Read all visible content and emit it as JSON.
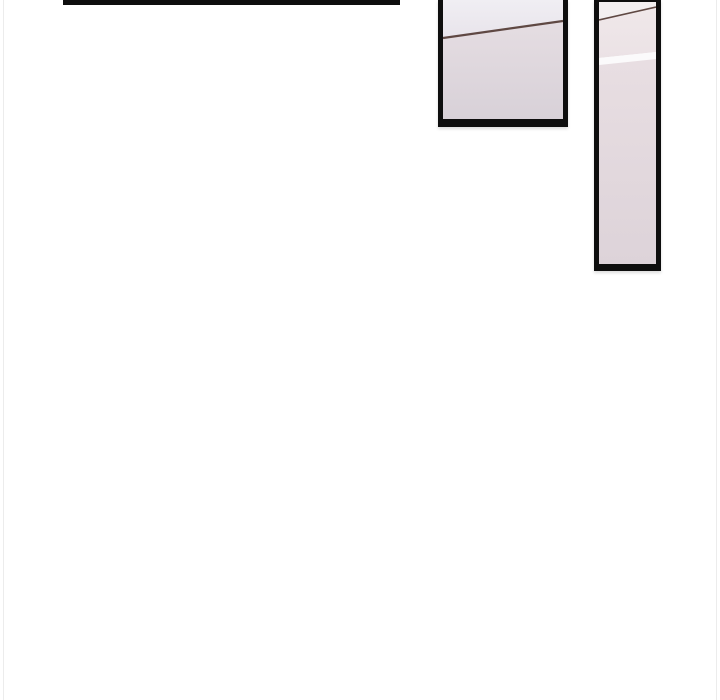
{
  "page": {
    "kind": "comic-page-fragment",
    "background": "#ffffff"
  },
  "colors": {
    "page-bg": "#ffffff",
    "edge-line": "#ececec",
    "ink": "#0e0e0e",
    "line-brown": "#5f4843",
    "mid-top-1": "#f0eef3",
    "mid-top-2": "#e8e4eb",
    "mid-bot-1": "#e5dde2",
    "mid-bot-2": "#d8d1d8",
    "right-top": "#f3eff0",
    "right-mid-1": "#f0e8ea",
    "right-mid-2": "#ebe2e5",
    "right-streak": "#fbfafb",
    "right-bot-1": "#e8dee2",
    "right-bot-2": "#ddd3d9"
  },
  "panels": [
    {
      "name": "cropped-panel-bottom-border",
      "description": "Bottom black border of a comic panel cropped above the viewport"
    },
    {
      "name": "wall-ceiling-panel",
      "description": "Cropped comic panel showing a pale lavender wall with a dark ceiling line"
    },
    {
      "name": "wall-sliver-panel",
      "description": "Tall narrow comic panel showing a pale wall with a white light streak"
    }
  ]
}
